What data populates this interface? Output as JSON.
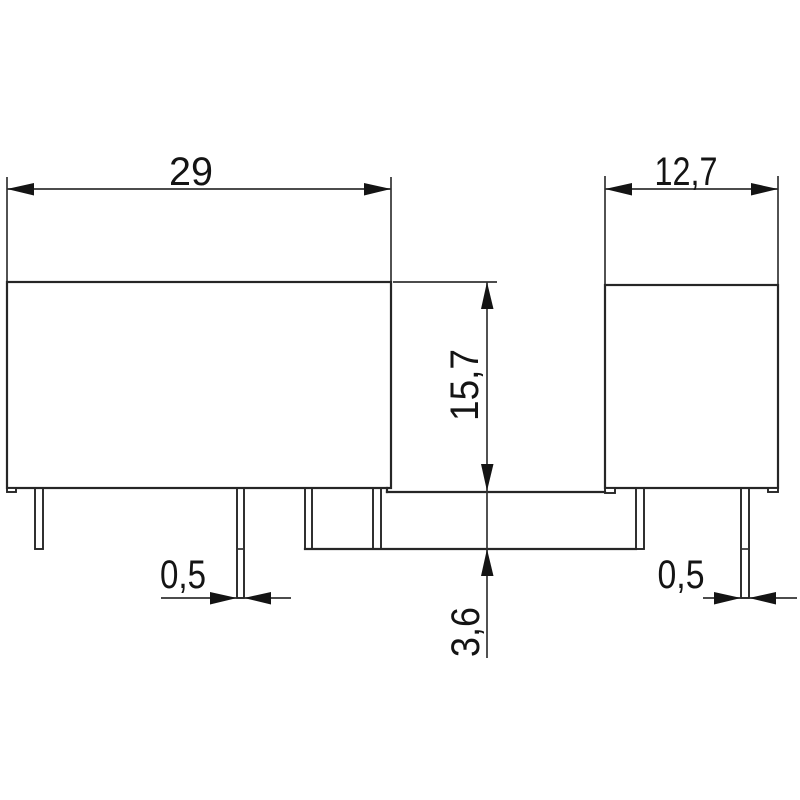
{
  "drawing": {
    "background_color": "#ffffff",
    "outline_color": "#262626",
    "dimension_line_color": "#333333",
    "text_color": "#141414",
    "views": {
      "front_view": "relay-front-outline",
      "side_view": "relay-side-outline"
    },
    "dimensions": {
      "body_length": {
        "label": "29"
      },
      "body_width": {
        "label": "12,7"
      },
      "body_height": {
        "label": "15,7"
      },
      "pin_protrusion": {
        "label": "3,6"
      },
      "pin_thickness_front": {
        "label": "0,5"
      },
      "pin_thickness_side": {
        "label": "0,5"
      }
    }
  }
}
